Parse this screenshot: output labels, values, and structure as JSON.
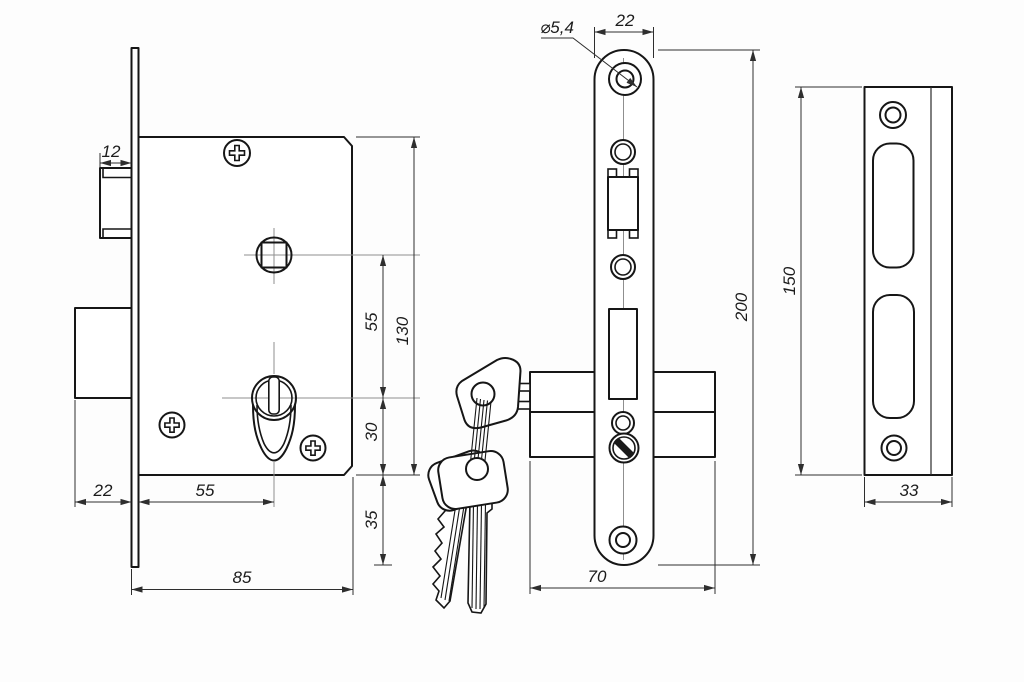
{
  "drawing_type": "lock technical drawing, three orthographic views with keys",
  "colors": {
    "background": "#fdfdfd",
    "outline": "#161616",
    "dimension": "#2e2e2e"
  },
  "dims": {
    "side": {
      "d12": "12",
      "d55v": "55",
      "d130": "130",
      "d30": "30",
      "d35": "35",
      "d22": "22",
      "d55h": "55",
      "d85": "85"
    },
    "front": {
      "dia": "⌀5,4",
      "d22": "22",
      "d200": "200",
      "d70": "70"
    },
    "strike": {
      "d150": "150",
      "d33": "33"
    }
  }
}
